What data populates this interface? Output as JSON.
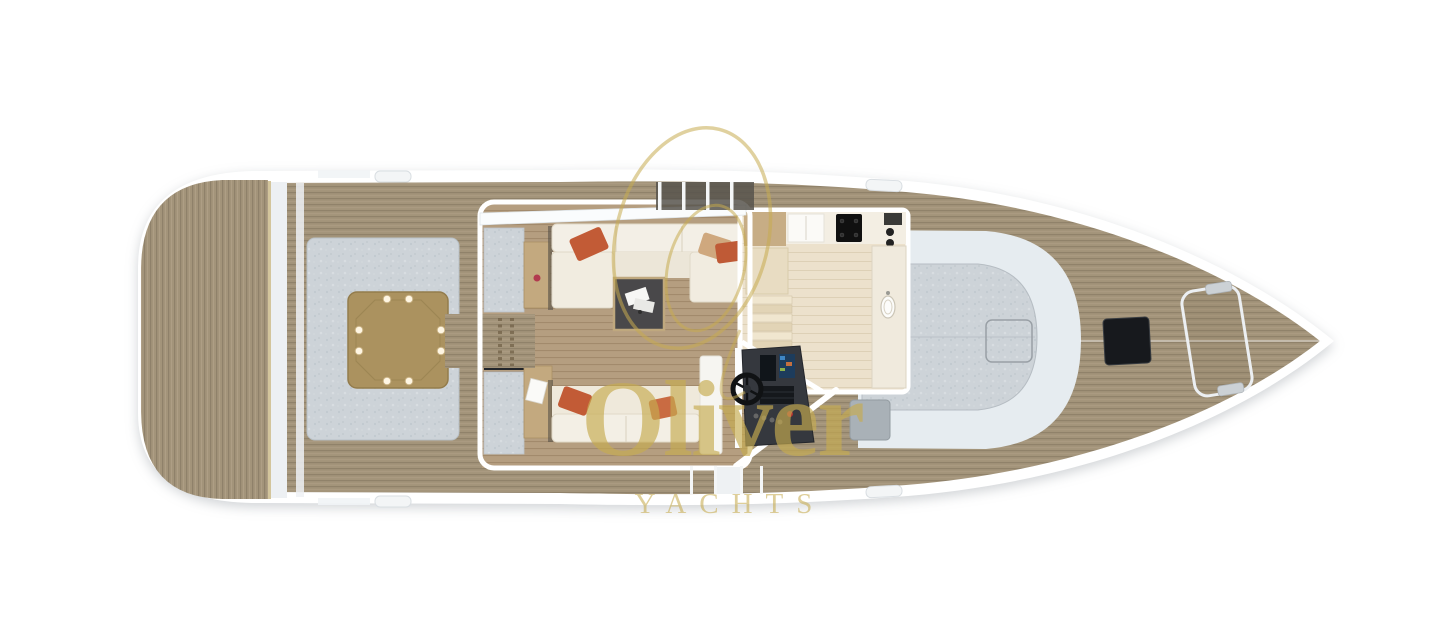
{
  "watermark": {
    "brand": "Oliver",
    "tagline": "YACHTS",
    "logo": "double-ellipse-monogram"
  },
  "colors": {
    "background": "#ffffff",
    "hull_white": "#ffffff",
    "hull_shadow": "#dfe5e9",
    "deck_wood": "#a3947a",
    "deck_wood_line": "#90826a",
    "salon_wood": "#b59e80",
    "galley_floor": "#ece1cc",
    "cushion_gray": "#cdd3d8",
    "sofa_cream": "#f1ece0",
    "pillow_orange": "#c25b36",
    "table_wood": "#ab925f",
    "helm_dark": "#35383e",
    "hatch_black": "#17191d",
    "windshield_glass": "#e6ecf0",
    "watermark_gold": "#c7ac50"
  }
}
